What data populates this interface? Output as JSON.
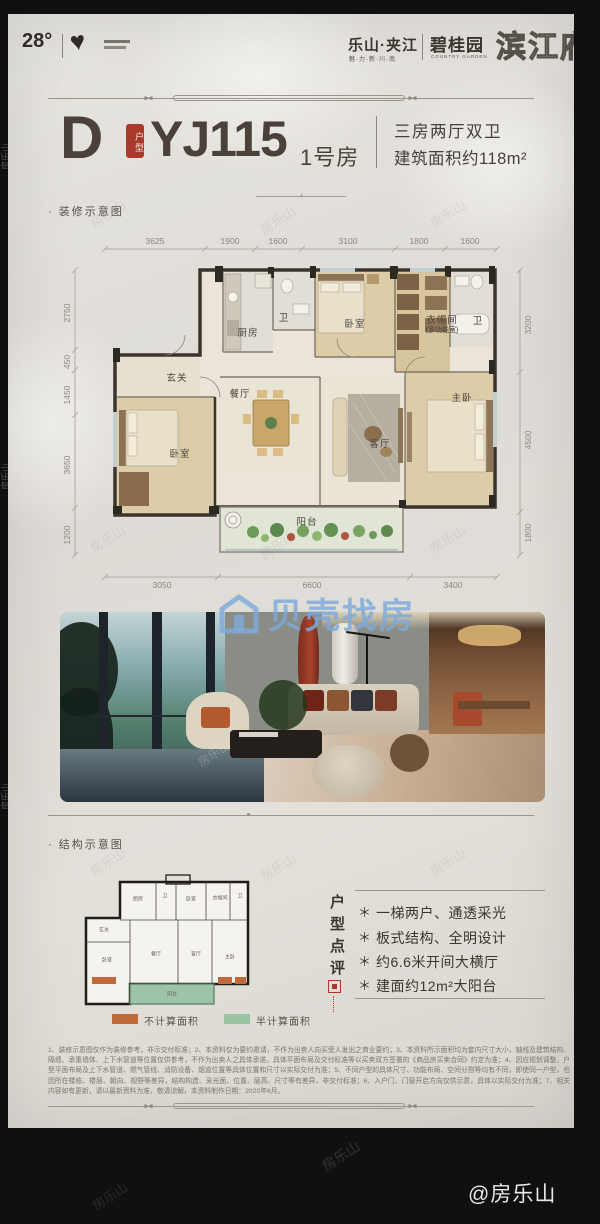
{
  "page": {
    "header": {
      "temperature": "28°",
      "location": "乐山·夹江",
      "location_sub": "魅·力·新·川·南",
      "brand": "碧桂园",
      "brand_sub": "COUNTRY GARDEN",
      "project": "滨江府"
    },
    "title": {
      "type_letter": "D",
      "type_seal": "户型",
      "model": "YJ115",
      "room": "1号房",
      "spec_line1": "三房两厅双卫",
      "spec_line2": "建筑面积约118m²"
    },
    "section_decor": "· 装修示意图",
    "section_structure": "· 结构示意图",
    "floorplan": {
      "dims_top": [
        "3625",
        "1900",
        "1600",
        "3100",
        "1800",
        "1600"
      ],
      "dims_left": [
        "2750",
        "450",
        "1450",
        "3650",
        "1200"
      ],
      "dims_right": [
        "3200",
        "4500",
        "1800"
      ],
      "dims_bottom": [
        "3050",
        "6600",
        "3400"
      ],
      "rooms": [
        {
          "label": "厨房"
        },
        {
          "label": "卫"
        },
        {
          "label": "玄关"
        },
        {
          "label": "餐厅"
        },
        {
          "label": "卧室"
        },
        {
          "label": "衣帽间",
          "sub": "(多功能室)"
        },
        {
          "label": "卫"
        },
        {
          "label": "主卧"
        },
        {
          "label": "卧室"
        },
        {
          "label": "客厅"
        },
        {
          "label": "阳台"
        }
      ]
    },
    "legend": [
      {
        "label": "不计算面积",
        "color": "#c2693c"
      },
      {
        "label": "半计算面积",
        "color": "#9cc3a6"
      }
    ],
    "review": {
      "title": "户型点评",
      "marker": "＊",
      "bullets": [
        "一梯两户、通透采光",
        "板式结构、全明设计",
        "约6.6米开间大横厅",
        "建面约12m²大阳台"
      ]
    },
    "disclaimer": "1、装修示意图仅作为装修参考，非示交付标准；2、本资料仅为要约邀请，不作为出卖人向买受人发出之商业要约；3、本资料所示面积均为套内尺寸大小，轴线及建筑结构、隔墙、承重墙体、上下水管道等位置仅供参考，不作为出卖人之具体承诺，具体平面布局及交付标准等以买卖双方签署的《商品房买卖合同》约定为准；4、因应规划调整，户型平面布局及上下水管道、燃气管线、消防设备、烟道位置等具体位置和尺寸以实际交付为准；5、不同户型的具体尺寸、功能布局、空间分割等均有不同，即使同一户型，也因所在楼栋、楼层、朝向、视野等差异，结构构造、采光面、位置、层高、尺寸等有差异，非交付标准；6、入户门、门窗开启方向仅供示意，具体以实际交付为准；7、相关内容如有更新，请以最新资料为准，敬请谅解，本资料制作日期：2020年6月。"
  },
  "watermarks": {
    "beike": "贝壳找房",
    "brand": "房乐山",
    "credit": "@房乐山"
  }
}
